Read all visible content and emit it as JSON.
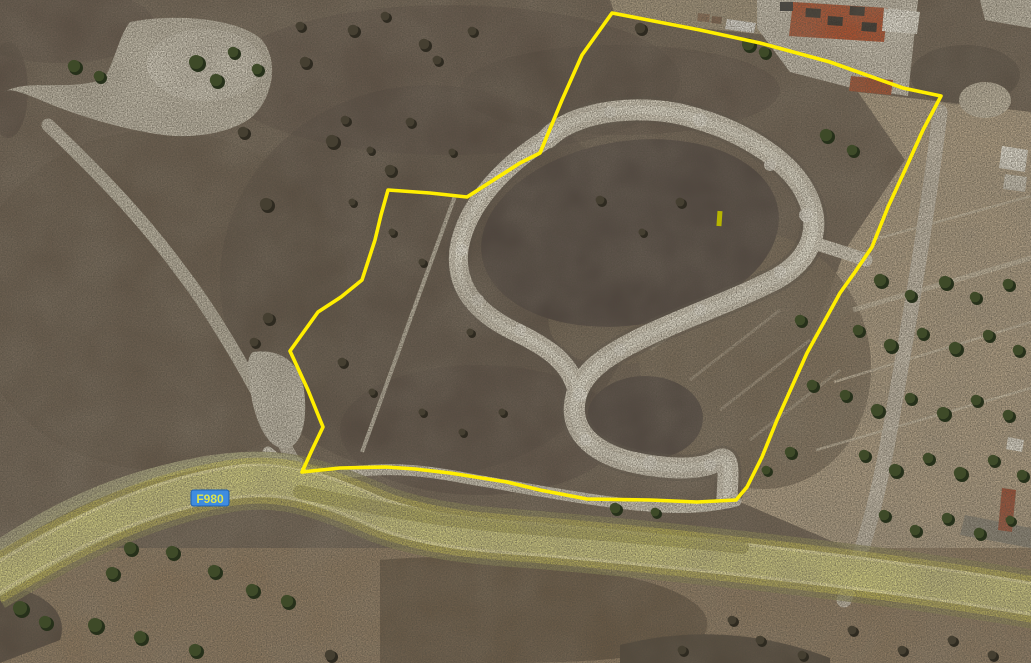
{
  "map": {
    "description": "satellite aerial view with parcel boundary overlay",
    "road_label": "F980",
    "colors": {
      "boundary": "#ffee00",
      "badge_fill": "#3f8ce0",
      "badge_text": "#dce350",
      "marker": "#b6b400",
      "tree_main": "#3e4a28",
      "tree_shadow": "#26301a",
      "bush_main": "#453f31",
      "bush_shadow": "#2e2a20"
    },
    "marker": {
      "x": 717,
      "y": 211,
      "width": 5,
      "height": 15
    },
    "badge": {
      "x": 191,
      "y": 490,
      "width": 38,
      "height": 16,
      "text_x": 210,
      "text_y": 503
    },
    "boundary_points": "612,13 700,30 760,43 830,62 903,88 941,96 923,130 905,170 888,207 872,247 855,272 840,293 807,353 777,420 762,457 747,487 736,500 697,502 650,500 587,499 540,490 507,482 450,473 415,469 386,467 340,468 302,472 312,450 323,427 308,390 290,351 318,312 341,297 362,280 375,240 381,215 388,190 430,193 467,197 520,163 540,153 562,100 582,55",
    "paths": {
      "road": "M -10,583 C 70,535 140,498 230,483 C 280,475 320,487 380,514 C 430,532 480,536 540,540 C 700,554 900,576 1041,601",
      "s_main": "M 548,138 C 575,110 645,102 695,118 C 745,132 792,162 807,196 C 823,230 810,260 776,279 C 733,301 688,316 648,335 C 610,353 585,369 577,393 C 567,424 585,448 624,460 C 662,470 700,471 717,461 C 731,452 728,474 727,497",
      "s_left": "M 548,138 C 507,163 466,204 459,249 C 454,289 479,314 514,331 C 547,347 569,361 577,390",
      "s_spur": "M 810,242 C 830,248 852,255 866,260",
      "bottom_track": "M 268,452 C 285,468 310,478 345,473 C 390,466 430,471 470,479 C 530,489 600,503 660,507 C 695,509 720,505 736,501",
      "left_thin_track": "M 455,196 L 362,452",
      "nw_path": "M 48,125 C 90,165 140,215 180,270 C 215,315 255,385 282,440 C 288,452 293,461 298,467",
      "right_track": "M 940,112 C 930,200 908,330 890,430 C 883,470 872,520 858,560 C 853,575 848,588 844,600",
      "left_verge": "M 0,545 C 60,505 120,478 200,463 C 240,456 272,456 298,463",
      "mid_verge": "M 300,492 C 360,505 430,520 520,527 C 620,535 690,541 742,547",
      "clearing": "M 130,22 C 180,12 242,20 262,40 C 280,62 272,98 253,116 C 233,133 193,140 156,134 C 118,128 72,114 38,99 C 18,91 8,88 4,92 C 28,78 68,92 104,79 C 116,58 119,36 130,22 Z",
      "mound": "M 253,352 C 280,348 300,362 304,390 C 308,420 302,444 288,448 C 272,452 258,430 252,400 C 248,375 245,358 253,352 Z",
      "fields_right": "M 858,92 L 1031,112 L 1031,598 L 900,570 L 740,502 L 765,450 L 800,370 L 845,250 L 905,160 Z",
      "apron": "M 757,0 L 918,0 L 908,96 L 852,88 L 790,72 L 757,28 Z",
      "top_dirt": "M 610,0 L 800,0 L 797,38 L 700,28 L 614,12 Z",
      "bottom_dark": "M 380,560 C 480,552 560,560 640,580 C 700,595 720,620 700,640 C 640,663 560,663 480,663 L 380,663 Z",
      "bottom_left_dark": "M 0,585 C 40,590 70,610 60,640 L 0,663 Z",
      "bottom_right_dark": "M 620,645 C 700,625 770,635 830,658 L 830,663 L 620,663 Z",
      "gray_patch_right": "M 965,515 L 1031,528 L 1031,548 L 960,535 Z"
    },
    "buildings": {
      "main_roof": "M 793,2 L 888,8 L 884,42 L 789,36 Z",
      "main_roof_wing": "M 884,8 L 920,12 L 917,34 L 882,31 Z",
      "small_red": "M 851,76 L 893,80 L 891,95 L 849,91 Z",
      "white_a": "M 1002,146 L 1028,150 L 1025,172 L 999,168 Z",
      "white_b": "M 1005,174 L 1027,177 L 1025,192 L 1003,189 Z",
      "corner_light": "M 980,0 L 1031,0 L 1031,28 L 985,20 Z",
      "red_edge": "M 1002,488 L 1016,490 L 1012,532 L 998,530 Z",
      "white_edge": "M 1008,437 L 1024,440 L 1022,452 L 1006,449 Z",
      "truck": "M 727,19 L 756,23 L 754,33 L 725,29 Z"
    },
    "parcel_lines": [
      "M 872,240 L 1031,196",
      "M 853,310 L 1031,258",
      "M 834,382 L 1031,322",
      "M 816,450 L 1031,388"
    ],
    "trees": [
      [
        74,
        66,
        7,
        0
      ],
      [
        99,
        76,
        6,
        0
      ],
      [
        196,
        62,
        8,
        0
      ],
      [
        216,
        80,
        7,
        0
      ],
      [
        233,
        52,
        6,
        0
      ],
      [
        257,
        69,
        6,
        0
      ],
      [
        305,
        62,
        6,
        1
      ],
      [
        353,
        30,
        6,
        1
      ],
      [
        300,
        26,
        5,
        1
      ],
      [
        424,
        44,
        6,
        1
      ],
      [
        385,
        16,
        5,
        1
      ],
      [
        332,
        141,
        7,
        1
      ],
      [
        390,
        170,
        6,
        1
      ],
      [
        266,
        204,
        7,
        1
      ],
      [
        243,
        132,
        6,
        1
      ],
      [
        437,
        60,
        5,
        1
      ],
      [
        472,
        31,
        5,
        1
      ],
      [
        640,
        28,
        6,
        1
      ],
      [
        748,
        44,
        7,
        0
      ],
      [
        764,
        52,
        6,
        0
      ],
      [
        826,
        135,
        7,
        0
      ],
      [
        852,
        150,
        6,
        0
      ],
      [
        880,
        280,
        7,
        0
      ],
      [
        910,
        295,
        6,
        0
      ],
      [
        945,
        282,
        7,
        0
      ],
      [
        975,
        297,
        6,
        0
      ],
      [
        1008,
        284,
        6,
        0
      ],
      [
        858,
        330,
        6,
        0
      ],
      [
        890,
        345,
        7,
        0
      ],
      [
        922,
        333,
        6,
        0
      ],
      [
        955,
        348,
        7,
        0
      ],
      [
        988,
        335,
        6,
        0
      ],
      [
        1018,
        350,
        6,
        0
      ],
      [
        845,
        395,
        6,
        0
      ],
      [
        877,
        410,
        7,
        0
      ],
      [
        910,
        398,
        6,
        0
      ],
      [
        943,
        413,
        7,
        0
      ],
      [
        976,
        400,
        6,
        0
      ],
      [
        1008,
        415,
        6,
        0
      ],
      [
        864,
        455,
        6,
        0
      ],
      [
        895,
        470,
        7,
        0
      ],
      [
        928,
        458,
        6,
        0
      ],
      [
        960,
        473,
        7,
        0
      ],
      [
        993,
        460,
        6,
        0
      ],
      [
        1022,
        475,
        6,
        0
      ],
      [
        884,
        515,
        6,
        0
      ],
      [
        915,
        530,
        6,
        0
      ],
      [
        947,
        518,
        6,
        0
      ],
      [
        979,
        533,
        6,
        0
      ],
      [
        1010,
        520,
        5,
        0
      ],
      [
        800,
        320,
        6,
        0
      ],
      [
        812,
        385,
        6,
        0
      ],
      [
        790,
        452,
        6,
        0
      ],
      [
        766,
        470,
        5,
        0
      ],
      [
        20,
        608,
        8,
        0
      ],
      [
        45,
        622,
        7,
        0
      ],
      [
        95,
        625,
        8,
        0
      ],
      [
        112,
        573,
        7,
        0
      ],
      [
        130,
        548,
        7,
        0
      ],
      [
        172,
        552,
        7,
        0
      ],
      [
        214,
        571,
        7,
        0
      ],
      [
        252,
        590,
        7,
        0
      ],
      [
        287,
        601,
        7,
        0
      ],
      [
        140,
        637,
        7,
        0
      ],
      [
        195,
        650,
        7,
        0
      ],
      [
        330,
        655,
        6,
        1
      ],
      [
        615,
        508,
        6,
        0
      ],
      [
        655,
        512,
        5,
        0
      ],
      [
        760,
        640,
        5,
        1
      ],
      [
        802,
        655,
        5,
        1
      ],
      [
        852,
        630,
        5,
        1
      ],
      [
        902,
        650,
        5,
        1
      ],
      [
        952,
        640,
        5,
        1
      ],
      [
        992,
        655,
        5,
        1
      ],
      [
        732,
        620,
        5,
        1
      ],
      [
        682,
        650,
        5,
        1
      ],
      [
        345,
        120,
        5,
        1
      ],
      [
        370,
        150,
        4,
        1
      ],
      [
        410,
        122,
        5,
        1
      ],
      [
        452,
        152,
        4,
        1
      ],
      [
        352,
        202,
        4,
        1
      ],
      [
        392,
        232,
        4,
        1
      ],
      [
        422,
        262,
        4,
        1
      ],
      [
        342,
        362,
        5,
        1
      ],
      [
        372,
        392,
        4,
        1
      ],
      [
        422,
        412,
        4,
        1
      ],
      [
        462,
        432,
        4,
        1
      ],
      [
        502,
        412,
        4,
        1
      ],
      [
        470,
        332,
        4,
        1
      ],
      [
        600,
        200,
        5,
        1
      ],
      [
        642,
        232,
        4,
        1
      ],
      [
        680,
        202,
        5,
        1
      ],
      [
        268,
        318,
        6,
        1
      ],
      [
        254,
        342,
        5,
        1
      ]
    ]
  }
}
